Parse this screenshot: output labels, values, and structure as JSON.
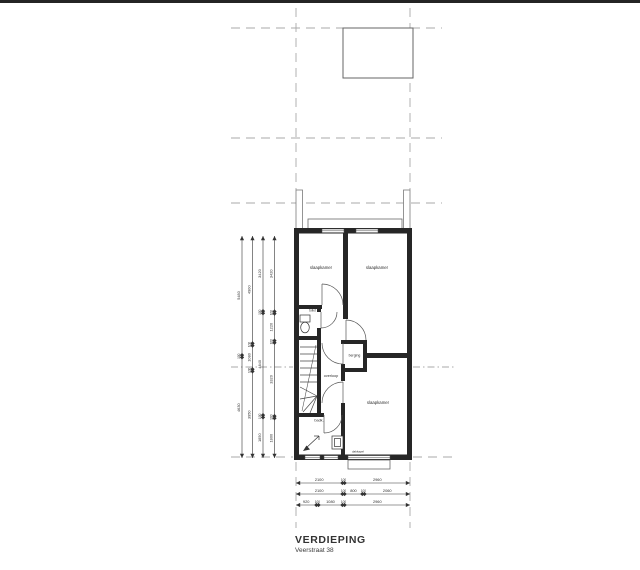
{
  "title_block": {
    "title": "VERDIEPING",
    "subtitle": "Veerstraat 38"
  },
  "colors": {
    "wall": "#262626",
    "grid_dash": "#a9a9a9",
    "dim": "#333333",
    "line": "#4a4a4a"
  },
  "rooms": [
    {
      "label": "slaapkamer",
      "x": 321,
      "y": 269,
      "size": 4.3
    },
    {
      "label": "slaapkamer",
      "x": 377,
      "y": 269,
      "size": 4.3
    },
    {
      "label": "toilet",
      "x": 312.5,
      "y": 311.5,
      "size": 3.2
    },
    {
      "label": "overloop",
      "x": 331,
      "y": 377,
      "size": 3.8
    },
    {
      "label": "berging",
      "x": 354.5,
      "y": 356.5,
      "size": 3.5
    },
    {
      "label": "badk.",
      "x": 319,
      "y": 421.5,
      "size": 3.8
    },
    {
      "label": "slaapkamer",
      "x": 378,
      "y": 404,
      "size": 4.3
    }
  ],
  "annotations": [
    {
      "label": "dakkapel",
      "x": 358,
      "y": 452.5,
      "size": 3.0
    }
  ],
  "dimensions": {
    "left_chains": [
      {
        "x": 242,
        "y1": 236,
        "y2": 458,
        "values": [
          "5480",
          "100",
          "4630"
        ]
      },
      {
        "x": 252.5,
        "y1": 236,
        "y2": 458,
        "values": [
          "4900",
          "100",
          "1080",
          "100",
          "3950"
        ]
      },
      {
        "x": 263,
        "y1": 236,
        "y2": 458,
        "values": [
          "3420",
          "100",
          "4640",
          "100",
          "1850"
        ]
      },
      {
        "x": 274.5,
        "y1": 236,
        "y2": 458,
        "values": [
          "3420",
          "100",
          "1220",
          "100",
          "3320",
          "100",
          "1800"
        ]
      }
    ],
    "bottom_chains": [
      {
        "y": 483,
        "x1": 296,
        "x2": 410,
        "values": [
          "2100",
          "100",
          "2960"
        ]
      },
      {
        "y": 494,
        "x1": 296,
        "x2": 410,
        "values": [
          "2100",
          "100",
          "800",
          "100",
          "2060"
        ]
      },
      {
        "y": 505,
        "x1": 296,
        "x2": 410,
        "values": [
          "920",
          "100",
          "1080",
          "100",
          "2960"
        ]
      }
    ]
  }
}
